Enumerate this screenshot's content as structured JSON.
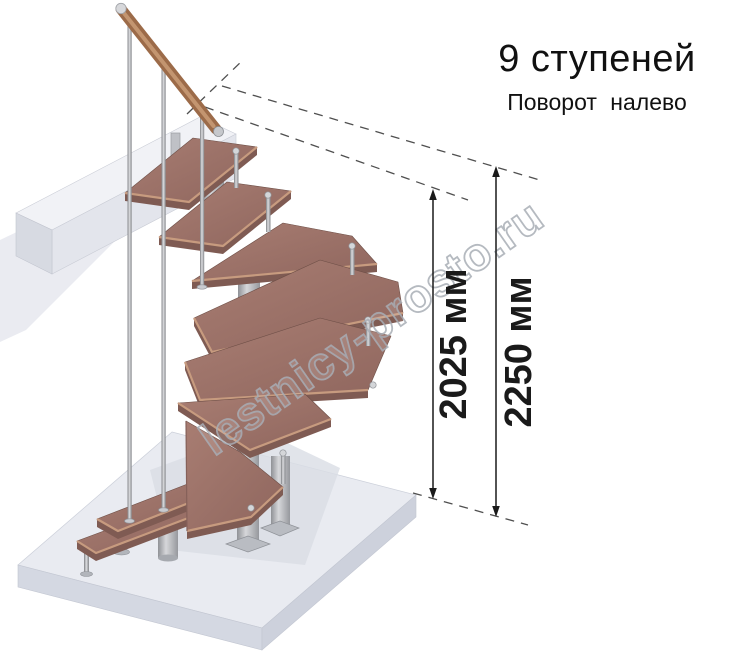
{
  "header": {
    "title": "9 ступеней",
    "subtitle": "Поворот налево"
  },
  "dimensions": {
    "stair_height": {
      "label": "2025 мм"
    },
    "total_height": {
      "label": "2250 мм"
    }
  },
  "watermark": {
    "text": "lestnicy-prosto.ru"
  },
  "illustration": {
    "tread_count": 9
  },
  "colors": {
    "tread-top": "#9d7268",
    "tread-top-light": "#a87d72",
    "tread-side": "#7f5b53",
    "tread-nose": "#c79b7f",
    "handrail": "#9c6b49",
    "handrail-light": "#c89a74",
    "metal": "#b9bcc0",
    "metal-dark": "#8d9095",
    "floor-top": "#e9ebf1",
    "floor-side": "#d4d8e2",
    "beam-top": "#f1f2f6",
    "beam-front": "#e3e5ec",
    "beam-end": "#d7dae2",
    "shadow": "#e6e8ee",
    "dash": "#4f4f4f",
    "dimension": "#1a1a1a",
    "watermark": "#a9aeb6"
  }
}
